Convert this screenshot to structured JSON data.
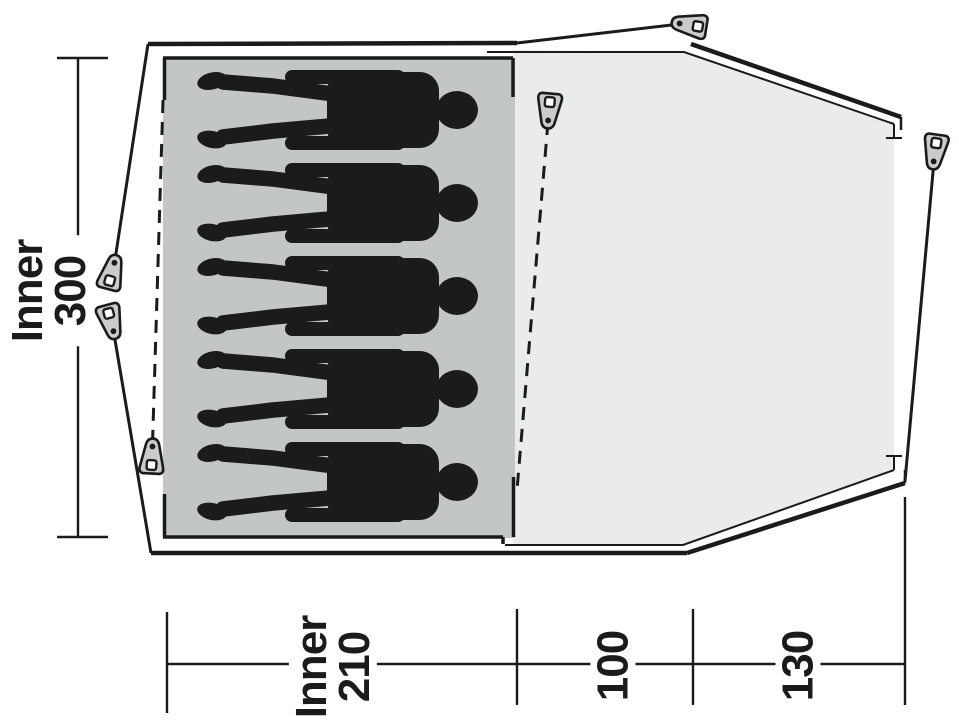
{
  "diagram": {
    "title": "tent-floorplan-top-view",
    "persons_count": 5,
    "pegs_count": 6,
    "dimensions": {
      "inner_width": {
        "line1": "Inner",
        "line2": "300"
      },
      "inner_depth": {
        "line1": "Inner",
        "line2": "210"
      },
      "porch_depth_front": "100",
      "porch_depth_door": "130"
    },
    "colors": {
      "inner_area": "#c3c7c3",
      "porch_area": "#e9ece9",
      "line": "#1b1b1b",
      "silhouette": "#1b1b1b",
      "peg_fill": "#c9cdc9",
      "background": "#ffffff"
    }
  }
}
